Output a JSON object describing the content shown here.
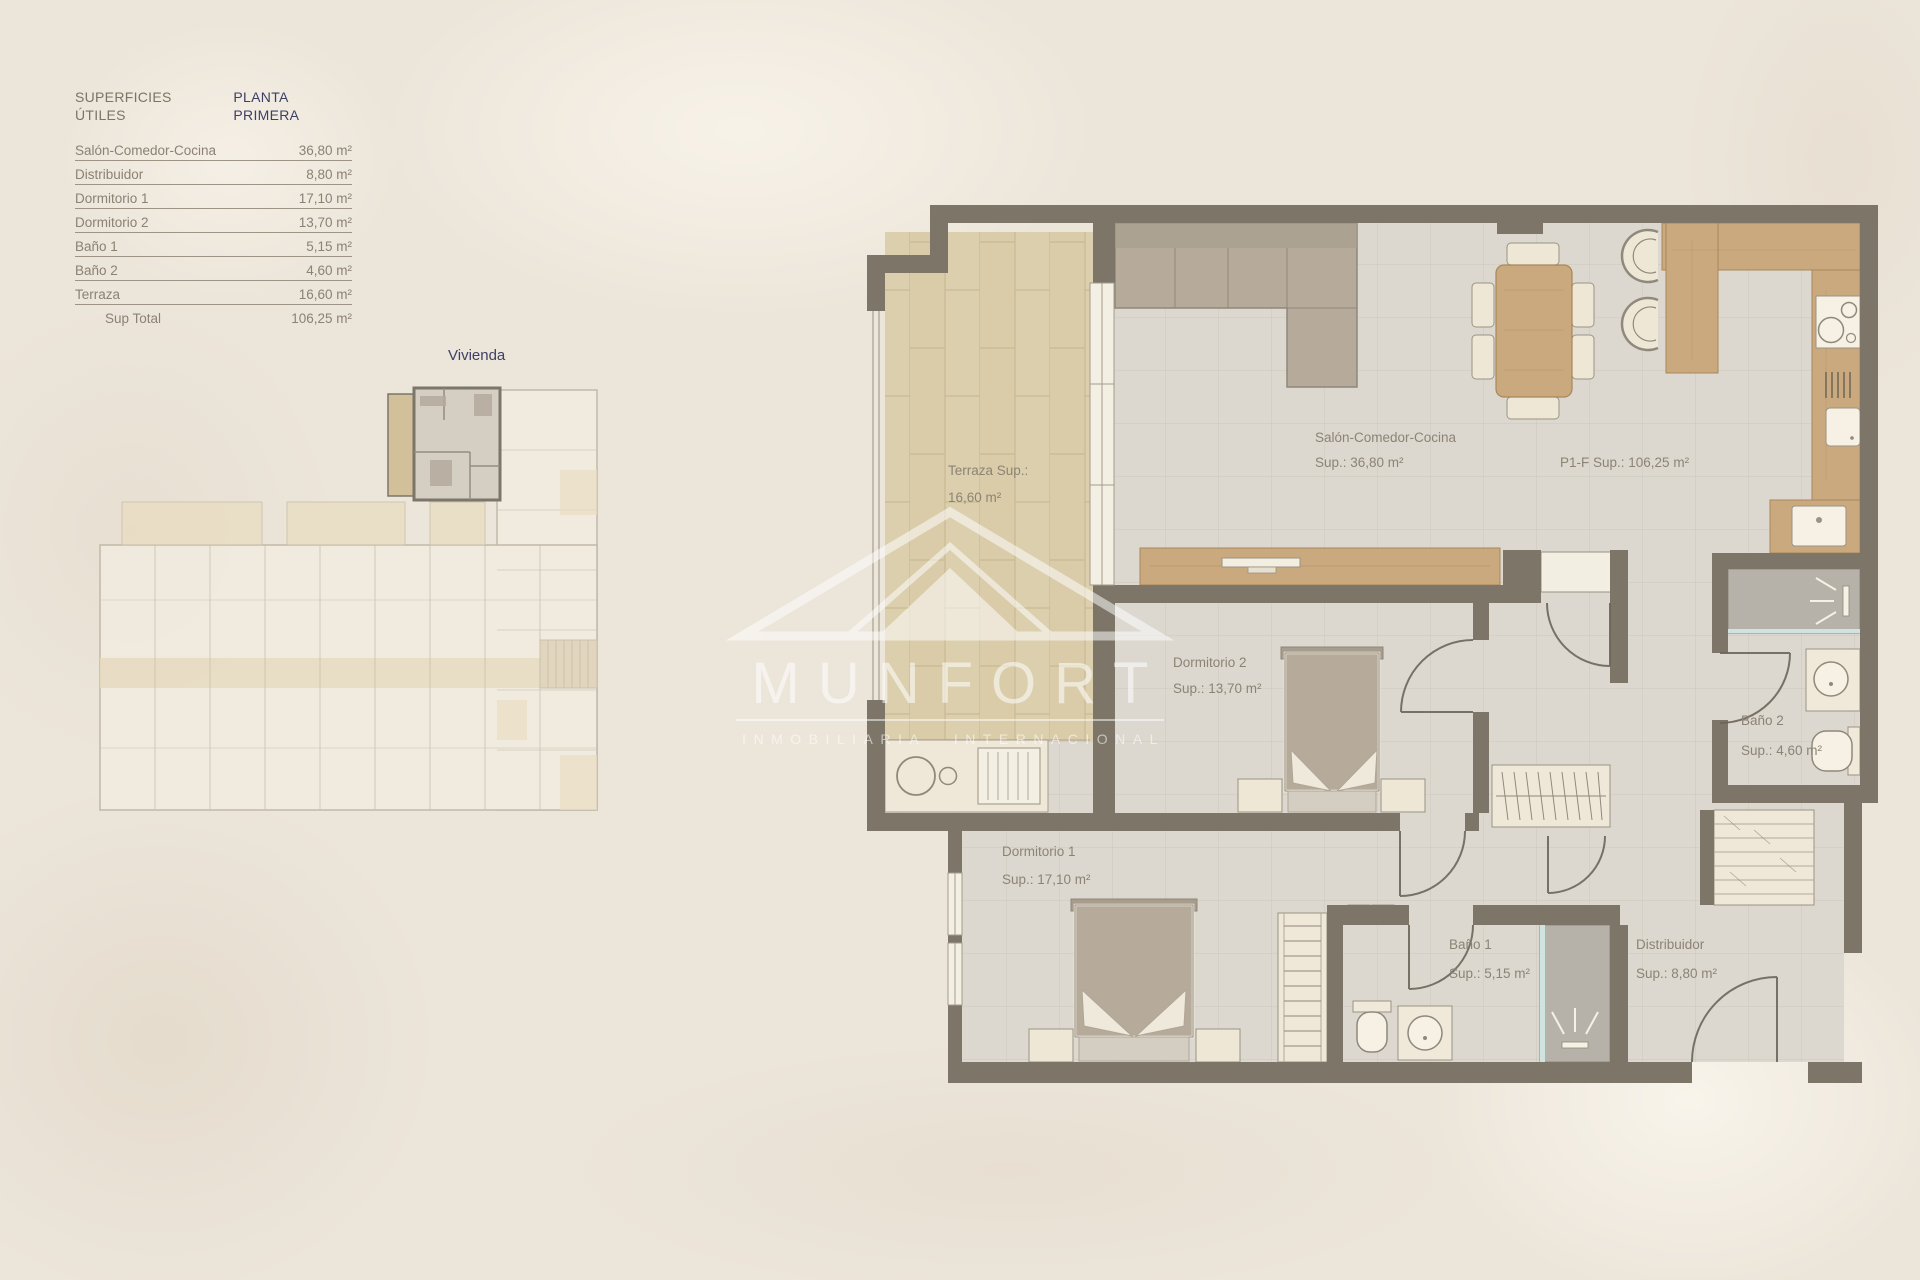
{
  "area_table": {
    "title_left": "SUPERFICIES ÚTILES",
    "title_right": "PLANTA PRIMERA",
    "rows": [
      {
        "label": "Salón-Comedor-Cocina",
        "value": "36,80 m²"
      },
      {
        "label": "Distribuidor",
        "value": "8,80 m²"
      },
      {
        "label": "Dormitorio 1",
        "value": "17,10 m²"
      },
      {
        "label": "Dormitorio 2",
        "value": "13,70 m²"
      },
      {
        "label": "Baño 1",
        "value": "5,15 m²"
      },
      {
        "label": "Baño 2",
        "value": "4,60 m²"
      },
      {
        "label": "Terraza",
        "value": "16,60 m²"
      }
    ],
    "total": {
      "label": "Sup Total",
      "value": "106,25 m²"
    }
  },
  "overview": {
    "label": "Vivienda"
  },
  "plan": {
    "unit_label": "P1-F Sup.: 106,25 m²",
    "terraza": {
      "l1": "Terraza Sup.:",
      "l2": "16,60 m²"
    },
    "salon": {
      "l1": "Salón-Comedor-Cocina",
      "l2": "Sup.: 36,80 m²"
    },
    "dormitorio2": {
      "l1": "Dormitorio 2",
      "l2": "Sup.: 13,70 m²"
    },
    "bano2": {
      "l1": "Baño 2",
      "l2": "Sup.: 4,60 m²"
    },
    "dormitorio1": {
      "l1": "Dormitorio 1",
      "l2": "Sup.: 17,10 m²"
    },
    "bano1": {
      "l1": "Baño 1",
      "l2": "Sup.: 5,15 m²"
    },
    "distribuidor": {
      "l1": "Distribuidor",
      "l2": "Sup.: 8,80 m²"
    }
  },
  "watermark": {
    "brand": "MUNFORT",
    "tagline": "INMOBILIARIA INTERNACIONAL"
  },
  "colors": {
    "background": "#ece5da",
    "wall": "#7d7668",
    "floor_tile": "#dcd8d0",
    "terrace_tile": "#dccfae",
    "wood": "#c9a97d",
    "furniture_taupe": "#b6ab9a",
    "accent_navy": "#3c3f66",
    "label_gray": "#8c8374"
  }
}
